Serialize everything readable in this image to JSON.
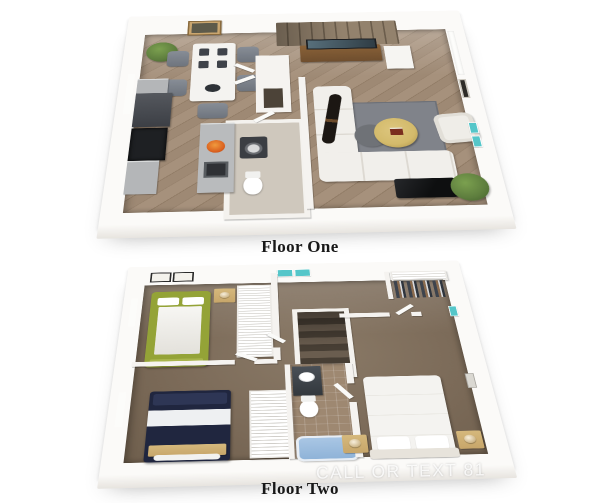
{
  "floors": [
    {
      "label": "Floor One"
    },
    {
      "label": "Floor Two"
    }
  ],
  "watermark": "CALL OR TEXT 81",
  "colors": {
    "page_bg": "#ffffff",
    "wall": "#f5f3f0",
    "slab": "#fbfaf8",
    "wood_floor": "#a18c77",
    "carpet": "#7c6b59",
    "carpet_dark": "#6f5f4d",
    "stair_brown": "#8d7d6a",
    "console_wood": "#7a5737",
    "appliance_dark": "#45484d",
    "stove_black": "#1e2023",
    "counter_gray": "#b4b6b8",
    "sofa_white": "#f1efeb",
    "rug_gray": "#80838a",
    "ottoman_yellow": "#d3ba6b",
    "coffee_table_black": "#1a1b1d",
    "plant_green": "#5e7e3e",
    "bed_green": "#94a337",
    "bed_navy": "#20263f",
    "bench_tan": "#d7c492",
    "nightstand_tan": "#c7a66a",
    "tub_blue": "#8fb3d8",
    "tile_tan": "#9e8871",
    "teal_accent": "#55c6c9",
    "caption_text": "#181818",
    "watermark_text": "rgba(255,255,255,0.82)"
  }
}
